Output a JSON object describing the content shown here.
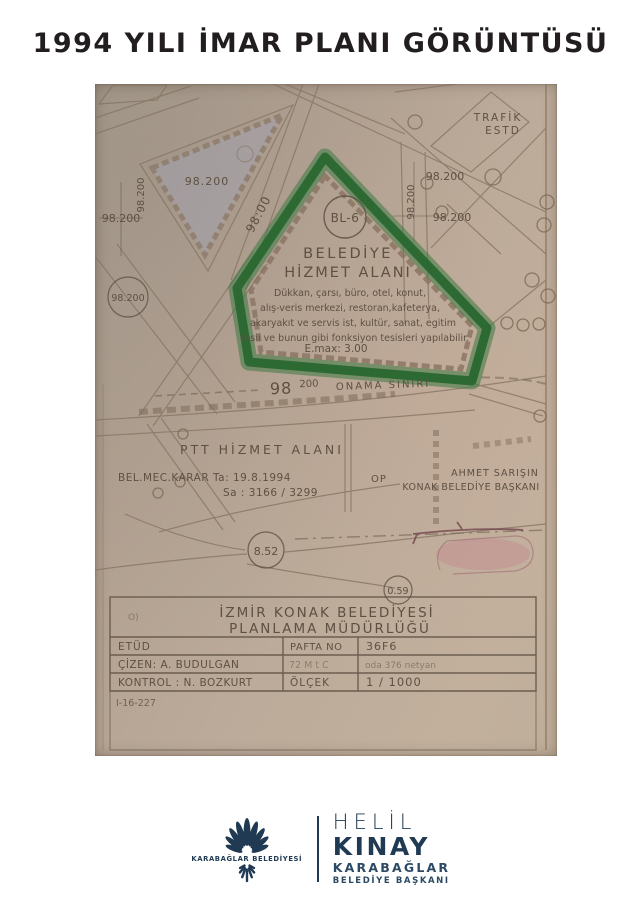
{
  "page": {
    "title": "1994 YILI İMAR PLANI GÖRÜNTÜSÜ"
  },
  "map": {
    "trafik_line1": "TRAFİK",
    "trafik_line2": "ESTD",
    "elev_value": "98.200",
    "elev_road": "98:00",
    "zone": {
      "code": "BL-6",
      "title_line1": "BELEDİYE",
      "title_line2": "HİZMET ALANI",
      "body_line1": "Dükkan, çarsı, büro, otel, konut,",
      "body_line2": "alış-veris merkezi, restoran,kafeterya,",
      "body_line3": "akaryakıt ve servis ist, kultür, sanat, egitim",
      "body_line4": "tesii ve bunun gibi fonksiyon tesisleri yapılabilir.",
      "emax": "E.max: 3.00"
    },
    "onama": {
      "big": "98",
      "small": "200",
      "label": "ONAMA SINIRI"
    },
    "ptt": {
      "title": "PTT HİZMET ALANI",
      "karar": "BEL.MEC.KARAR  Ta: 19.8.1994",
      "sayi": "Sa : 3166 / 3299"
    },
    "op_label": "OP",
    "mayor": {
      "line1": "AHMET SARIŞIN",
      "line2": "KONAK BELEDİYE BAŞKANI"
    },
    "circle_852": "8.52",
    "circle_059": "0.59",
    "table": {
      "header_line1": "İZMİR  KONAK  BELEDİYESİ",
      "header_line2": "PLANLAMA  MÜDÜRLÜĞÜ",
      "stamp_mark": "O)",
      "etud": "ETÜD",
      "pafta_label": "PAFTA NO",
      "pafta_value": "36F6",
      "cizen": "ÇİZEN:   A. BUDULGAN",
      "mid_note": "72 M t C",
      "right_note": "oda 376 netyan",
      "kontrol": "KONTROL : N. BOZKURT",
      "olcek_label": "ÖLÇEK",
      "olcek_value": "1 / 1000",
      "ref_code": "I-16-227"
    }
  },
  "footer": {
    "muni_name": "KARABAĞLAR BELEDİYESİ",
    "name_line1": "HELİL",
    "name_line2": "KINAY",
    "name_line3": "KARABAĞLAR",
    "name_line4": "BELEDİYE BAŞKANI"
  },
  "colors": {
    "highlight_green": "#2e6e35",
    "brand_navy": "#1f3a52",
    "map_ink": "#5e5043",
    "paper_tan": "#b5a493",
    "pink_note": "#c4848e"
  }
}
